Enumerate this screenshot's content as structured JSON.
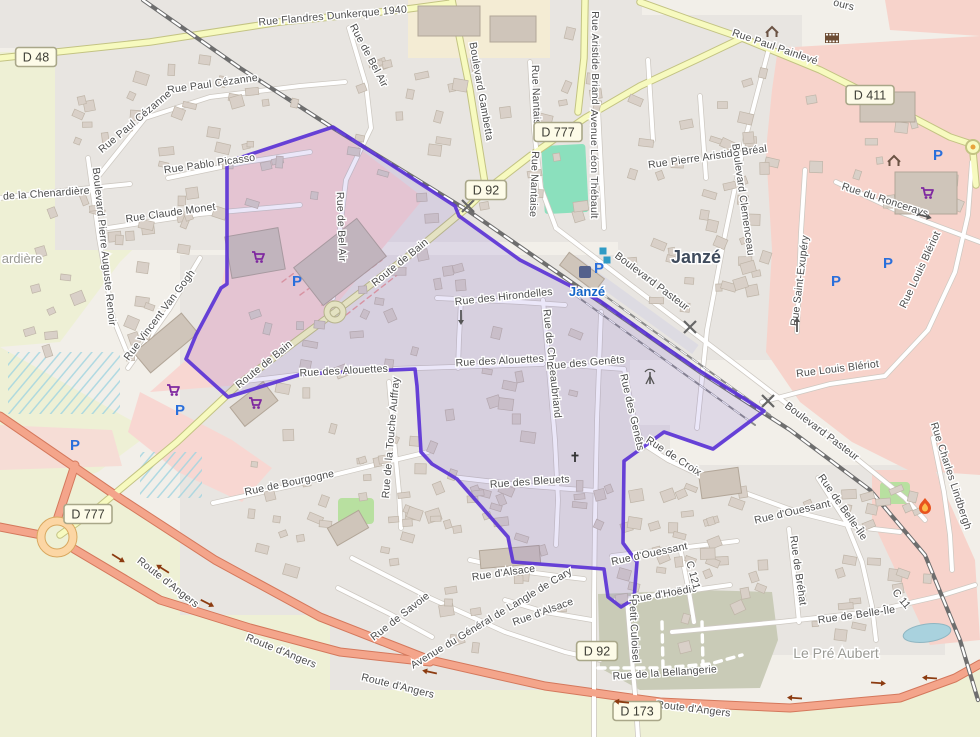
{
  "map": {
    "colors": {
      "background": "#f2efe9",
      "residential": "#e8e5e1",
      "retail_pink": "#f8d7d2",
      "commercial_pink": "#f7d3cb",
      "farmland": "#eef0d5",
      "olive_area": "#c9cbb7",
      "pitch_green": "#8be0bd",
      "park_green": "#b8e0a0",
      "water": "#a9d2de",
      "road_yellow": "#f7fabf",
      "road_trunk": "#f4a58b",
      "road_primary": "#fcd6a4",
      "railway": "#6e6e6e",
      "boundary_stroke": "#5b33d6",
      "boundary_fill": "rgba(98,74,210,0.14)",
      "label_gray": "#4d4d4d",
      "station_blue": "#1465c8"
    },
    "place_labels": [
      {
        "t": "Janzé",
        "x": 696,
        "y": 263,
        "s": 18,
        "c": "#3f4b5c",
        "w": "bold"
      },
      {
        "t": "Janzé",
        "x": 587,
        "y": 296,
        "s": 13,
        "c": "#1465c8",
        "w": "bold"
      },
      {
        "t": "Le Pré Aubert",
        "x": 836,
        "y": 658,
        "s": 14,
        "c": "#9a9a94",
        "w": "normal"
      },
      {
        "t": "ardière",
        "x": 22,
        "y": 263,
        "s": 13,
        "c": "#9a9a94",
        "w": "normal"
      }
    ],
    "street_labels": [
      {
        "t": "Rue Flandres Dunkerque 1940",
        "x": 333,
        "y": 19,
        "r": -5
      },
      {
        "t": "Rue Paul Painlevé",
        "x": 774,
        "y": 50,
        "r": 19
      },
      {
        "t": "Boulevard Gambetta",
        "x": 478,
        "y": 92,
        "r": 80
      },
      {
        "t": "Rue Nantaise",
        "x": 533,
        "y": 98,
        "r": 88
      },
      {
        "t": "Rue Nantaise",
        "x": 531,
        "y": 184,
        "r": 92
      },
      {
        "t": "Rue Aristide Briand",
        "x": 592,
        "y": 58,
        "r": 90
      },
      {
        "t": "Avenue Léon Thébault",
        "x": 591,
        "y": 164,
        "r": 90
      },
      {
        "t": "Rue Pierre Aristide Bréal",
        "x": 708,
        "y": 160,
        "r": -8
      },
      {
        "t": "Boulevard Clemenceau",
        "x": 740,
        "y": 200,
        "r": 82
      },
      {
        "t": "Rue du Roncerays",
        "x": 884,
        "y": 203,
        "r": 18
      },
      {
        "t": "ours",
        "x": 843,
        "y": 8,
        "r": 14
      },
      {
        "t": "Rue de Bel Air",
        "x": 366,
        "y": 57,
        "r": 62
      },
      {
        "t": "Rue de Bel Air",
        "x": 338,
        "y": 227,
        "r": 88
      },
      {
        "t": "Rue Paul Cézanne",
        "x": 213,
        "y": 87,
        "r": -8
      },
      {
        "t": "Rue Paul Cézanne",
        "x": 137,
        "y": 124,
        "r": -40
      },
      {
        "t": "Rue Pablo Picasso",
        "x": 210,
        "y": 167,
        "r": -8
      },
      {
        "t": "Rue Claude Monet",
        "x": 171,
        "y": 216,
        "r": -8
      },
      {
        "t": "Boulevard Pierre Auguste Renoir",
        "x": 101,
        "y": 247,
        "r": 84
      },
      {
        "t": "Rue Vincent Van Gogh",
        "x": 162,
        "y": 317,
        "r": -53
      },
      {
        "t": "n de la Chenardière",
        "x": 42,
        "y": 197,
        "r": -4
      },
      {
        "t": "Route de Bain",
        "x": 402,
        "y": 265,
        "r": -39
      },
      {
        "t": "Route de Bain",
        "x": 266,
        "y": 367,
        "r": -39
      },
      {
        "t": "Rue des Hirondelles",
        "x": 504,
        "y": 300,
        "r": -6
      },
      {
        "t": "Rue des Alouettes",
        "x": 344,
        "y": 374,
        "r": -3
      },
      {
        "t": "Rue des Alouettes",
        "x": 500,
        "y": 364,
        "r": -3
      },
      {
        "t": "Rue de Chateaubriand",
        "x": 549,
        "y": 364,
        "r": 84
      },
      {
        "t": "Rue des Genêts",
        "x": 586,
        "y": 366,
        "r": -5
      },
      {
        "t": "Rue des Genêts",
        "x": 629,
        "y": 413,
        "r": 77
      },
      {
        "t": "Rue de Croix",
        "x": 672,
        "y": 459,
        "r": 33
      },
      {
        "t": "Boulevard Pasteur",
        "x": 650,
        "y": 284,
        "r": 37
      },
      {
        "t": "Boulevard Pasteur",
        "x": 820,
        "y": 434,
        "r": 37
      },
      {
        "t": "Rue Saint-Exupéry",
        "x": 803,
        "y": 281,
        "r": -83
      },
      {
        "t": "Rue Louis Blériot",
        "x": 923,
        "y": 271,
        "r": -65
      },
      {
        "t": "Rue Louis Blériot",
        "x": 838,
        "y": 372,
        "r": -7
      },
      {
        "t": "Rue Charles Lindbergh",
        "x": 948,
        "y": 477,
        "r": 72
      },
      {
        "t": "Rue de Belle-Île",
        "x": 840,
        "y": 509,
        "r": 55
      },
      {
        "t": "Rue de Belle-Île",
        "x": 857,
        "y": 618,
        "r": -8
      },
      {
        "t": "C 11",
        "x": 899,
        "y": 601,
        "r": 50
      },
      {
        "t": "Rue de Bréhat",
        "x": 795,
        "y": 571,
        "r": 82
      },
      {
        "t": "Rue d'Ouessant",
        "x": 793,
        "y": 515,
        "r": -13
      },
      {
        "t": "Rue d'Ouessant",
        "x": 650,
        "y": 557,
        "r": -12
      },
      {
        "t": "Rue d'Hoëdic",
        "x": 665,
        "y": 597,
        "r": -10
      },
      {
        "t": "C 121",
        "x": 690,
        "y": 576,
        "r": 75
      },
      {
        "t": "Petit Culoisel",
        "x": 631,
        "y": 631,
        "r": 87
      },
      {
        "t": "Rue d'Alsace",
        "x": 504,
        "y": 576,
        "r": -8
      },
      {
        "t": "Rue d'Alsace",
        "x": 544,
        "y": 615,
        "r": -20
      },
      {
        "t": "Avenue du Général de Langle de Cary",
        "x": 493,
        "y": 621,
        "r": -31
      },
      {
        "t": "Rue de Savoie",
        "x": 402,
        "y": 619,
        "r": -38
      },
      {
        "t": "Rue de Bourgogne",
        "x": 290,
        "y": 486,
        "r": -12
      },
      {
        "t": "Rue des Bleuets",
        "x": 530,
        "y": 485,
        "r": -4
      },
      {
        "t": "Rue de la Touche Auffray",
        "x": 394,
        "y": 438,
        "r": -85
      },
      {
        "t": "Rue de la Bellangerie",
        "x": 665,
        "y": 676,
        "r": -4
      },
      {
        "t": "Route d'Angers",
        "x": 166,
        "y": 585,
        "r": 38
      },
      {
        "t": "Route d'Angers",
        "x": 280,
        "y": 654,
        "r": 22
      },
      {
        "t": "Route d'Angers",
        "x": 397,
        "y": 689,
        "r": 14
      },
      {
        "t": "Route d'Angers",
        "x": 693,
        "y": 712,
        "r": 7
      }
    ],
    "shields": [
      {
        "t": "D 48",
        "x": 36,
        "y": 57
      },
      {
        "t": "D 411",
        "x": 870,
        "y": 95
      },
      {
        "t": "D 777",
        "x": 558,
        "y": 132
      },
      {
        "t": "D 92",
        "x": 486,
        "y": 190
      },
      {
        "t": "D 777",
        "x": 88,
        "y": 514
      },
      {
        "t": "D 92",
        "x": 597,
        "y": 651
      },
      {
        "t": "D 173",
        "x": 637,
        "y": 711
      }
    ],
    "icons": [
      {
        "type": "supermarket",
        "x": 258,
        "y": 257
      },
      {
        "type": "supermarket",
        "x": 173,
        "y": 390
      },
      {
        "type": "supermarket",
        "x": 255,
        "y": 403
      },
      {
        "type": "supermarket",
        "x": 927,
        "y": 193
      },
      {
        "type": "parking",
        "x": 297,
        "y": 281
      },
      {
        "type": "parking",
        "x": 180,
        "y": 410
      },
      {
        "type": "parking",
        "x": 75,
        "y": 445
      },
      {
        "type": "parking",
        "x": 599,
        "y": 268
      },
      {
        "type": "parking",
        "x": 836,
        "y": 281
      },
      {
        "type": "parking",
        "x": 888,
        "y": 263
      },
      {
        "type": "parking",
        "x": 938,
        "y": 155
      },
      {
        "type": "station",
        "x": 585,
        "y": 272
      },
      {
        "type": "bus-stop",
        "x": 603,
        "y": 251
      },
      {
        "type": "bus-stop",
        "x": 607,
        "y": 260
      },
      {
        "type": "mast",
        "x": 650,
        "y": 378
      },
      {
        "type": "cross",
        "x": 575,
        "y": 457
      },
      {
        "type": "fire-station",
        "x": 925,
        "y": 505
      },
      {
        "type": "shelter",
        "x": 772,
        "y": 32
      },
      {
        "type": "shelter",
        "x": 894,
        "y": 161
      },
      {
        "type": "cinema",
        "x": 832,
        "y": 38
      },
      {
        "type": "pond",
        "x": 927,
        "y": 633
      }
    ],
    "oneway_arrows": [
      {
        "x": 118,
        "y": 558,
        "r": 32,
        "c": "#8c3b10"
      },
      {
        "x": 163,
        "y": 569,
        "r": 212,
        "c": "#8c3b10"
      },
      {
        "x": 207,
        "y": 603,
        "r": 27,
        "c": "#8c3b10"
      },
      {
        "x": 430,
        "y": 672,
        "r": 192,
        "c": "#8c3b10"
      },
      {
        "x": 622,
        "y": 702,
        "r": 186,
        "c": "#8c3b10"
      },
      {
        "x": 795,
        "y": 698,
        "r": 184,
        "c": "#8c3b10"
      },
      {
        "x": 878,
        "y": 683,
        "r": 4,
        "c": "#8c3b10"
      },
      {
        "x": 930,
        "y": 678,
        "r": 184,
        "c": "#8c3b10"
      },
      {
        "x": 797,
        "y": 325,
        "r": -90,
        "c": "#555555"
      },
      {
        "x": 461,
        "y": 317,
        "r": 90,
        "c": "#555555"
      },
      {
        "x": 924,
        "y": 216,
        "r": 15,
        "c": "#555555"
      }
    ],
    "rail_crossings": [
      {
        "x": 468,
        "y": 206
      },
      {
        "x": 690,
        "y": 327
      },
      {
        "x": 768,
        "y": 401
      }
    ],
    "boundary": {
      "points": [
        [
          333,
          127
        ],
        [
          455,
          206
        ],
        [
          459,
          216
        ],
        [
          520,
          260
        ],
        [
          600,
          301
        ],
        [
          665,
          347
        ],
        [
          700,
          371
        ],
        [
          764,
          411
        ],
        [
          713,
          449
        ],
        [
          664,
          432
        ],
        [
          624,
          461
        ],
        [
          623,
          543
        ],
        [
          637,
          562
        ],
        [
          634,
          599
        ],
        [
          621,
          607
        ],
        [
          608,
          597
        ],
        [
          604,
          569
        ],
        [
          513,
          562
        ],
        [
          508,
          537
        ],
        [
          457,
          479
        ],
        [
          432,
          464
        ],
        [
          421,
          452
        ],
        [
          417,
          386
        ],
        [
          415,
          369
        ],
        [
          344,
          372
        ],
        [
          302,
          374
        ],
        [
          228,
          397
        ],
        [
          186,
          359
        ],
        [
          196,
          335
        ],
        [
          221,
          288
        ],
        [
          227,
          284
        ],
        [
          227,
          162
        ]
      ]
    }
  }
}
